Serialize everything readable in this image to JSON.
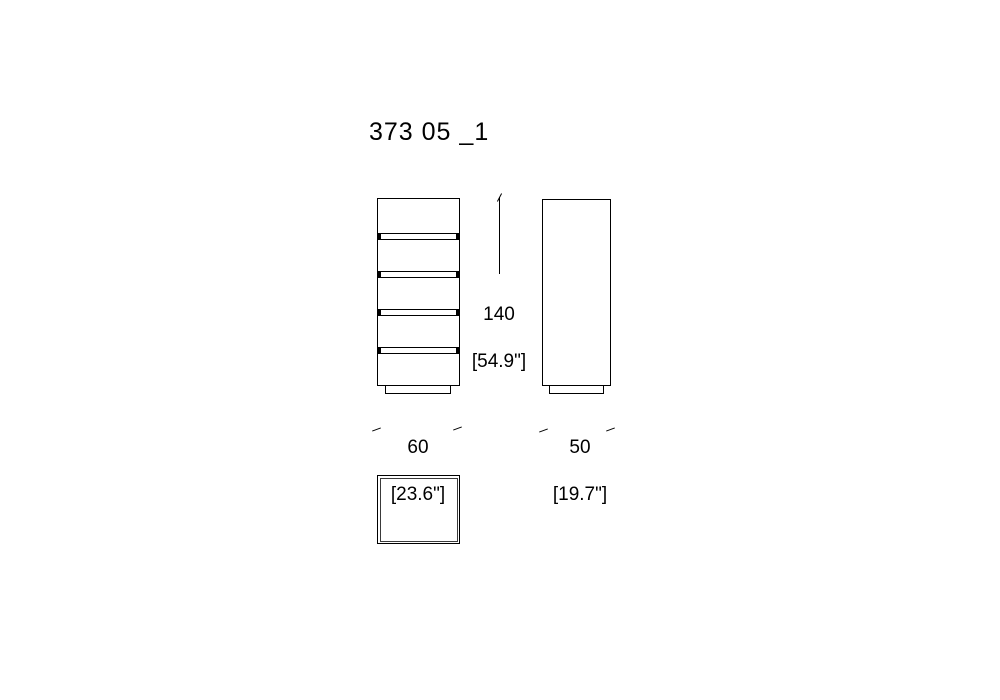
{
  "page": {
    "background_color": "#ffffff",
    "line_color": "#000000"
  },
  "title": "373 05 _1",
  "figure": {
    "type": "furniture technical drawing",
    "views": {
      "front": {
        "drawer_count": 5,
        "has_plinth": true
      },
      "side": {
        "has_plinth": true
      },
      "top": {
        "double_outline": true
      }
    }
  },
  "dimensions": {
    "height": {
      "value": "140",
      "imperial": "[54.9\"]"
    },
    "width": {
      "value": "60",
      "imperial": "[23.6\"]"
    },
    "depth": {
      "value": "50",
      "imperial": "[19.7\"]"
    }
  }
}
